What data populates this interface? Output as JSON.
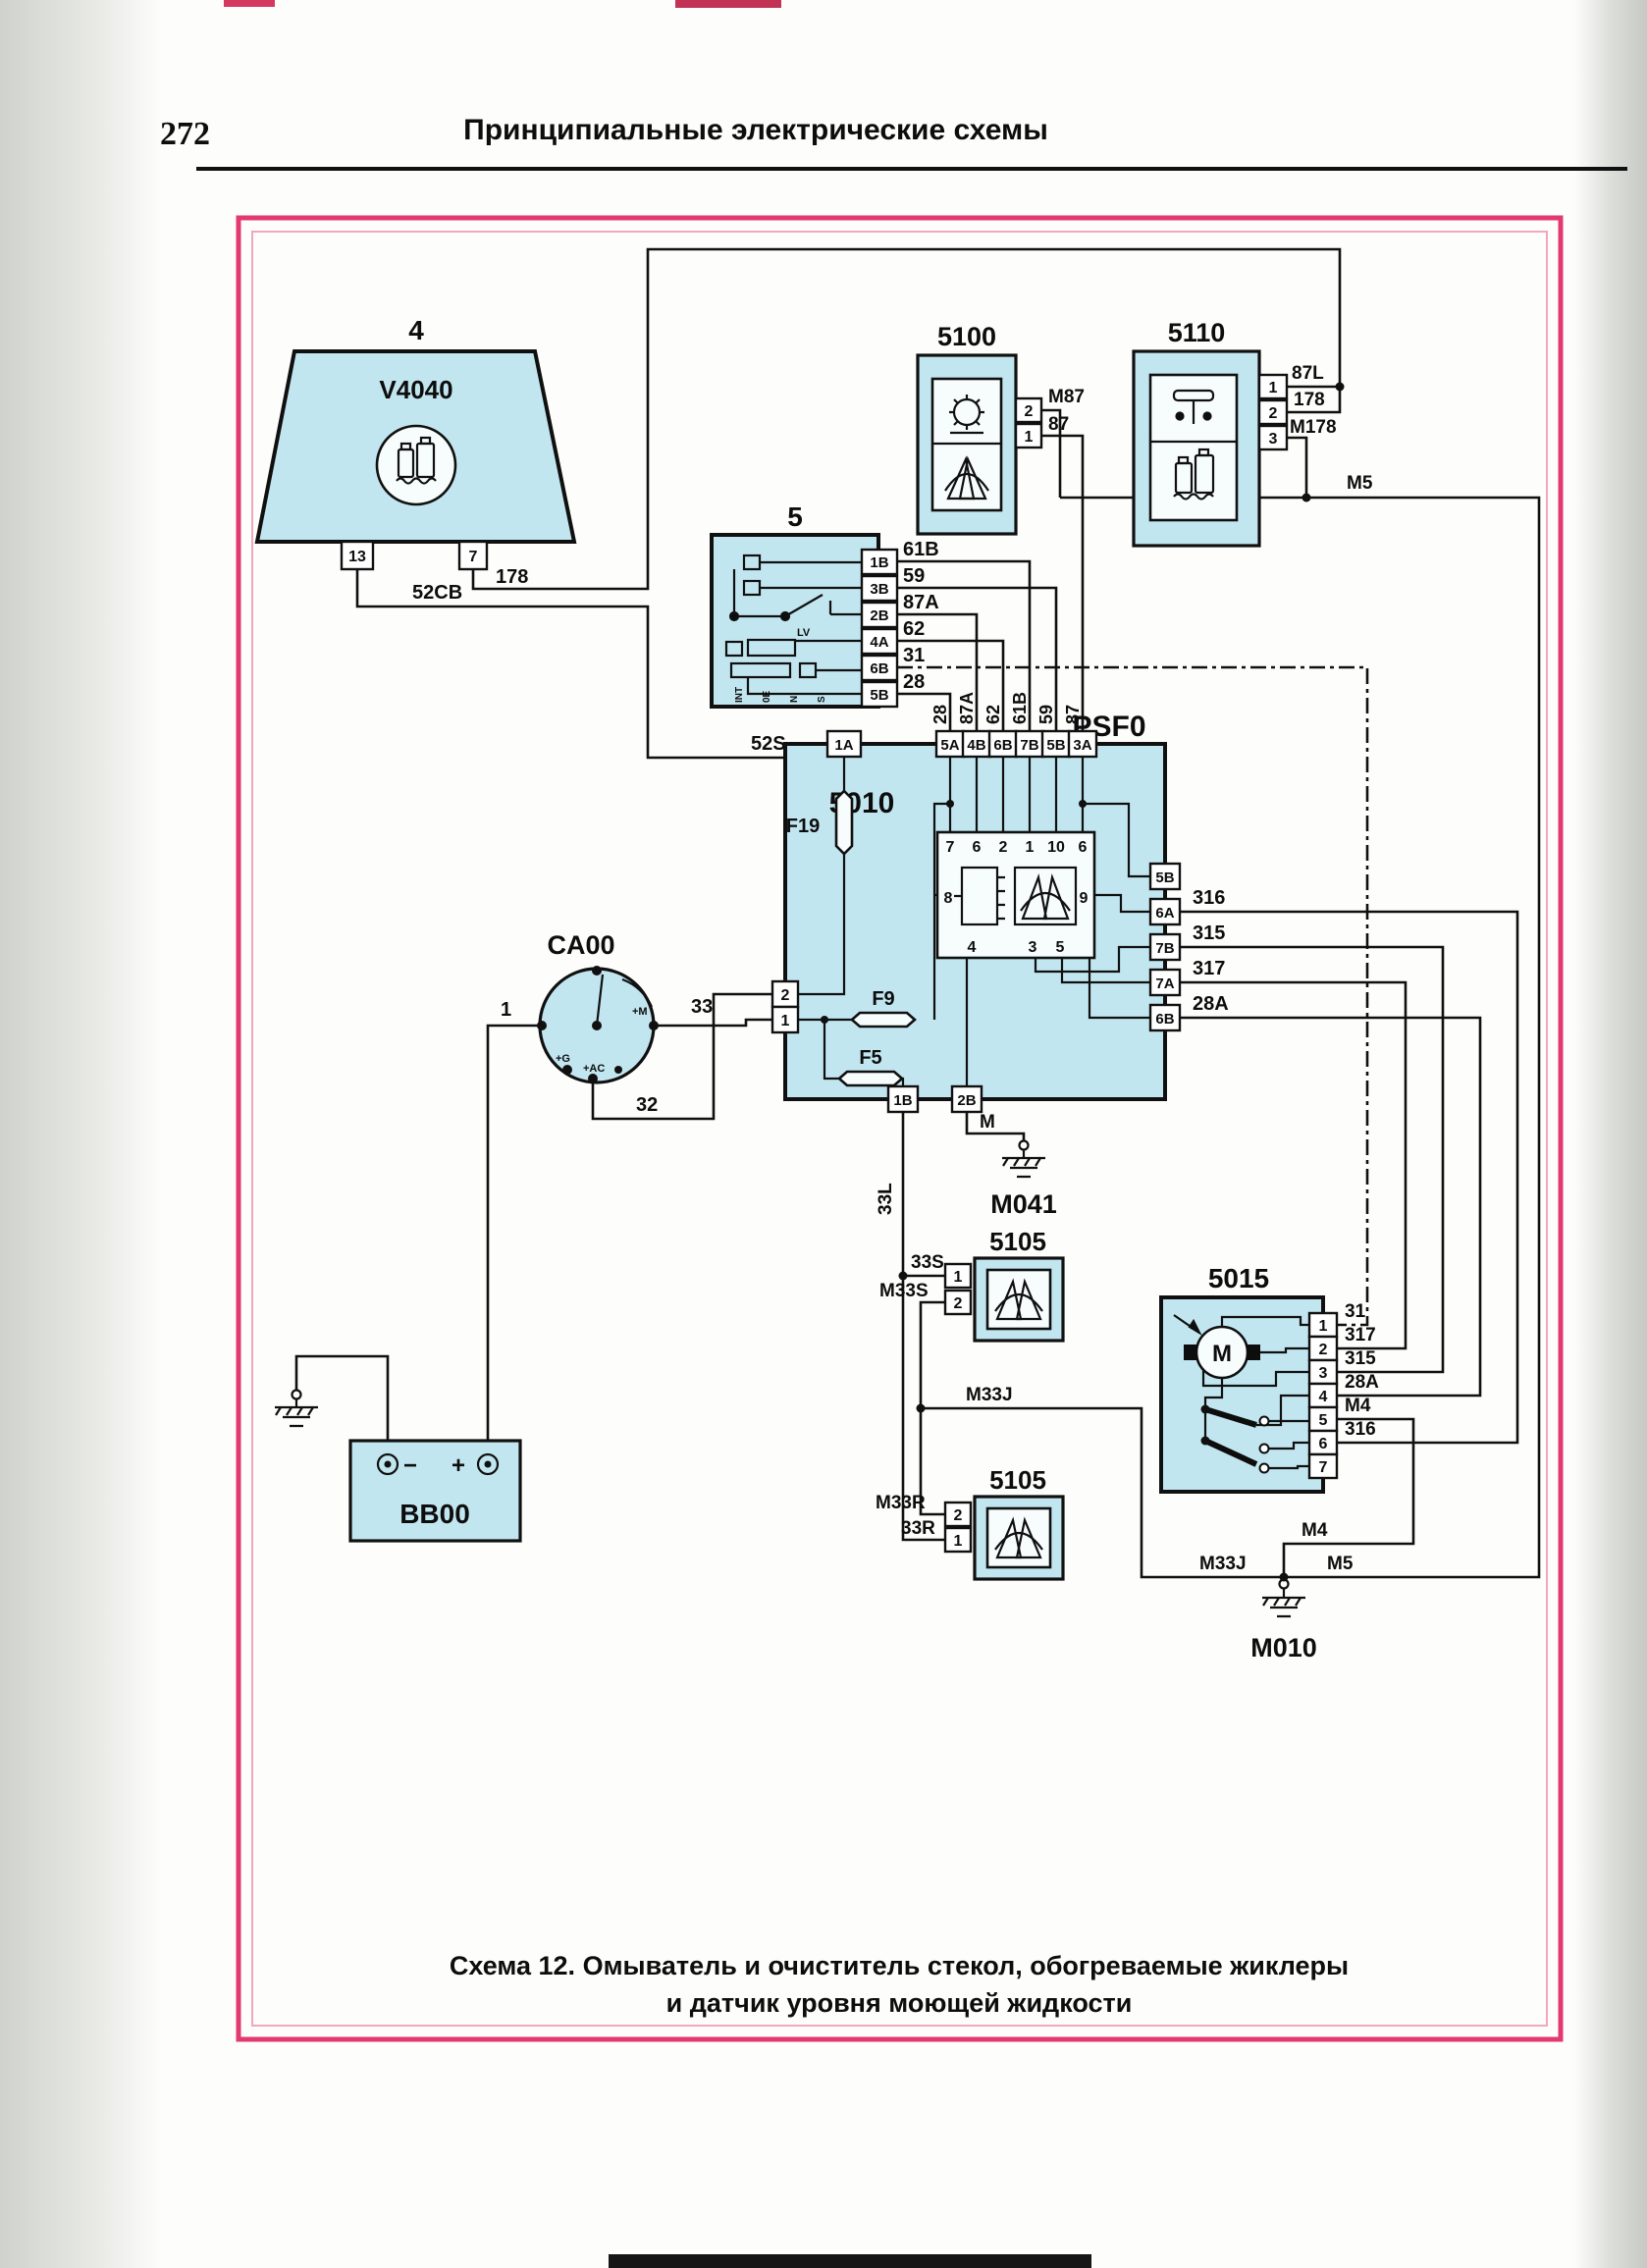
{
  "page": {
    "number": "272",
    "header": "Принципиальные электрические схемы",
    "caption": [
      "Схема 12. Омыватель и очиститель стекол, обогреваемые жиклеры",
      "и датчик уровня моющей жидкости"
    ]
  },
  "colors": {
    "block_fill": "#c2e6f0",
    "frame_outer": "#e23a70",
    "frame_inner": "#f2a6c0",
    "wire": "#101010"
  },
  "diagram": {
    "v4040": {
      "ref": "4",
      "code": "V4040",
      "pins": [
        "13",
        "7"
      ]
    },
    "pump5100": {
      "code": "5100",
      "pins": [
        "2",
        "1"
      ],
      "wire_labels": [
        "M87",
        "87"
      ]
    },
    "relay5110": {
      "code": "5110",
      "pins": [
        "1",
        "2",
        "3"
      ],
      "wire_labels": [
        "87L",
        "178",
        "M178"
      ]
    },
    "switch5": {
      "ref": "5",
      "lv": "LV",
      "positions": [
        "INT",
        "0E",
        "N",
        "S"
      ],
      "pins": [
        "1B",
        "3B",
        "2B",
        "4A",
        "6B",
        "5B"
      ],
      "wire_labels": [
        "61B",
        "59",
        "87A",
        "62",
        "31",
        "28"
      ]
    },
    "psf0": {
      "code": "PSF0",
      "module": "5010",
      "conn_1a": "1A",
      "top_connectors": [
        "5A",
        "4B",
        "6B",
        "7B",
        "5B",
        "3A"
      ],
      "top_wire_labels": [
        "28",
        "87A",
        "62",
        "61B",
        "59",
        "87"
      ],
      "left_pins": [
        "2",
        "1"
      ],
      "bottom_pins": [
        "1B",
        "2B"
      ],
      "right_connectors": [
        "5B",
        "6A",
        "7B",
        "7A",
        "6B"
      ],
      "right_wire_labels": [
        "316",
        "315",
        "317",
        "28A"
      ],
      "fuses": [
        "F19",
        "F9",
        "F5"
      ],
      "relay": {
        "top_pins": [
          "7",
          "6",
          "2",
          "1",
          "10",
          "6"
        ],
        "left_pin": "8",
        "right_pin": "9",
        "bottom_pins": [
          "4",
          "3",
          "5"
        ]
      }
    },
    "ca00": {
      "code": "CA00",
      "contact_labels": [
        "+M",
        "+G",
        "+AC"
      ]
    },
    "bb00": {
      "code": "BB00",
      "terminals": [
        "−",
        "+"
      ]
    },
    "jet5105_top": {
      "code": "5105",
      "pins": [
        "1",
        "2"
      ],
      "wire_labels": [
        "33S",
        "M33S"
      ]
    },
    "jet5105_bottom": {
      "code": "5105",
      "pins": [
        "2",
        "1"
      ],
      "wire_labels": [
        "M33R",
        "33R"
      ]
    },
    "motor5015": {
      "code": "5015",
      "motor": "M",
      "pins": [
        "1",
        "2",
        "3",
        "4",
        "5",
        "6",
        "7"
      ],
      "wire_labels": [
        "31",
        "317",
        "315",
        "28A",
        "M4",
        "316"
      ]
    },
    "grounds": {
      "m041": "M041",
      "m010": "M010"
    },
    "wires": {
      "w178": "178",
      "w52cb": "52CB",
      "w52s": "52S",
      "w1": "1",
      "w33": "33",
      "w32": "32",
      "w33l": "33L",
      "w_m": "M",
      "m5_top": "M5",
      "m5_bottom": "M5",
      "m4_top": "M4",
      "m4_bottom": "M4",
      "m33j_mid": "M33J",
      "m33j_bottom": "M33J"
    }
  }
}
